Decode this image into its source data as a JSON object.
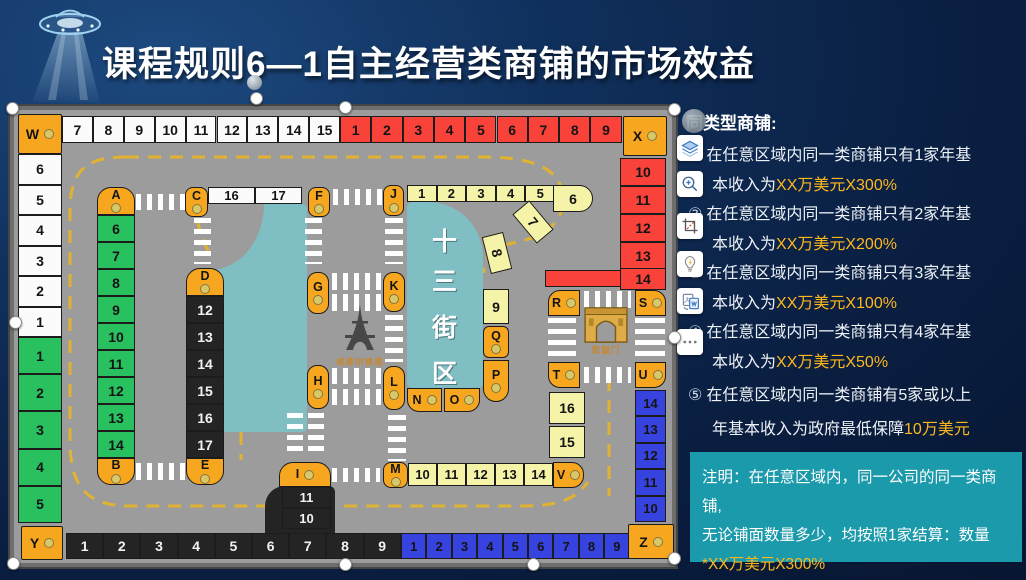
{
  "title": "课程规则6—1自主经营类商铺的市场效益",
  "rules_panel": {
    "header": "同类型商铺:",
    "items": [
      {
        "num": "①",
        "line1": "在任意区域内同一类商铺只有1家年基",
        "line2_plain": "本收入为",
        "line2_highlight": "XX万美元X300%"
      },
      {
        "num": "②",
        "line1": "在任意区域内同一类商铺只有2家年基",
        "line2_plain": "本收入为",
        "line2_highlight": "XX万美元X200%"
      },
      {
        "num": "③",
        "line1": "在任意区域内同一类商铺只有3家年基",
        "line2_plain": "本收入为",
        "line2_highlight": "XX万美元X100%"
      },
      {
        "num": "④",
        "line1": "在任意区域内同一类商铺只有4家年基",
        "line2_plain": "本收入为",
        "line2_highlight": "XX万美元X50%"
      },
      {
        "num": "⑤",
        "line1": "在任意区域内同一类商铺有5家或以上",
        "line2_plain": "年基本收入为政府最低保障",
        "line2_highlight": "10万美元"
      }
    ]
  },
  "note": {
    "line1": "注明：在任意区域内，同一公司的同一类商铺,",
    "line2": "无论铺面数量多少，均按照1家结算：数量",
    "highlight": "*XX万美元X300%"
  },
  "toolbar": {
    "icons": [
      "collapse-circle",
      "layers",
      "zoom-in",
      "crop",
      "idea-bulb",
      "doc-convert",
      "more"
    ]
  },
  "board": {
    "corners": [
      "W",
      "X",
      "Y",
      "Z"
    ],
    "caps": [
      "A",
      "B",
      "C",
      "D",
      "E",
      "F",
      "G",
      "H",
      "I",
      "J",
      "K",
      "L",
      "M",
      "N",
      "O",
      "P",
      "Q",
      "R",
      "S",
      "T",
      "U",
      "V"
    ],
    "rows": {
      "top_white": [
        "7",
        "8",
        "9",
        "10",
        "11",
        "12",
        "13",
        "14",
        "15"
      ],
      "top_red": [
        "1",
        "2",
        "3",
        "4",
        "5",
        "6",
        "7",
        "8",
        "9"
      ],
      "left_white": [
        "6",
        "5",
        "4",
        "3",
        "2",
        "1"
      ],
      "left_green": [
        "1",
        "2",
        "3",
        "4",
        "5"
      ],
      "bottom_black": [
        "1",
        "2",
        "3",
        "4",
        "5",
        "6",
        "7",
        "8",
        "9"
      ],
      "bottom_blue": [
        "1",
        "2",
        "3",
        "4",
        "5",
        "6",
        "7",
        "8",
        "9"
      ],
      "right_red": [
        "10",
        "11",
        "12",
        "13"
      ],
      "right_red_band": "14",
      "right_blue": [
        "14",
        "13",
        "12",
        "11",
        "10"
      ]
    },
    "streets": {
      "green": [
        "6",
        "7",
        "8",
        "9",
        "10",
        "11",
        "12",
        "13",
        "14"
      ],
      "black_mid": [
        "12",
        "13",
        "14",
        "15",
        "16",
        "17"
      ],
      "black_low": [
        "11",
        "10"
      ],
      "yellow_top": [
        "1",
        "2",
        "3",
        "4",
        "5"
      ],
      "yellow_curve": [
        "6",
        "7",
        "8"
      ],
      "yellow_nine": "9",
      "yellow_bottom": [
        "10",
        "11",
        "12",
        "13",
        "14"
      ],
      "yellow_right": [
        "16",
        "15"
      ],
      "top_mid_white": [
        "16",
        "17"
      ]
    },
    "landmarks": {
      "district": "十三街区",
      "eiffel": "埃菲尔铁塔",
      "arc": "凯旋门"
    }
  },
  "colors": {
    "background": "#0a1f42",
    "road": "#9C9C9C",
    "cell_orange": "#F6A71F",
    "cell_red": "#F8423A",
    "cell_green": "#29C05F",
    "cell_blue": "#3743DF",
    "cell_black": "#242424",
    "cell_pale_yellow": "#F5F3A7",
    "teal_block": "#7FBEC3",
    "note_box": "#1B9AAB",
    "highlight_text": "#FFB81C",
    "dashed_line": "#E5B42D"
  }
}
